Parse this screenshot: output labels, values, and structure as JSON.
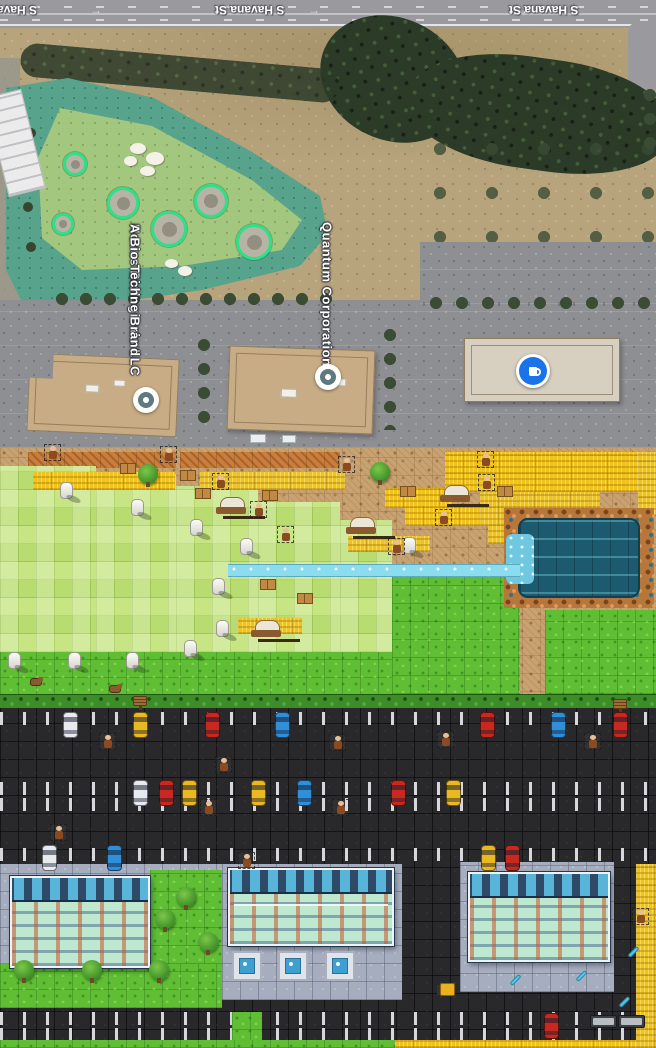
{
  "meta": {
    "title": "Aerial satellite map above pixel-art game recreation of the same area",
    "canvas": {
      "width": 656,
      "height": 1048
    }
  },
  "satellite": {
    "street": {
      "label_full_1": "S Havana St",
      "label_full_2": "S Havana St",
      "label_partial": "S Havana St",
      "direction_arrow": "→"
    },
    "pois": [
      {
        "id": "novus",
        "label_line_1": "Novus Biologicals LLC",
        "label_line_2": "A Bio-Techne Brand",
        "marker": "dot",
        "x": 146,
        "y": 400
      },
      {
        "id": "quantum",
        "label_line_1": "Quantum Corporation",
        "marker": "dot",
        "x": 328,
        "y": 377
      },
      {
        "id": "cafe",
        "marker": "cafe-blue-circle",
        "x": 533,
        "y": 371
      }
    ],
    "range_targets": [
      [
        78,
        167,
        12
      ],
      [
        66,
        227,
        11
      ],
      [
        126,
        206,
        16
      ],
      [
        172,
        232,
        18
      ],
      [
        214,
        204,
        17
      ],
      [
        257,
        245,
        18
      ]
    ],
    "colors": {
      "road": "#9a9a9e",
      "dirt": "#b7a47c",
      "range_outer": "#57a38c",
      "range_inner": "#a3c77e",
      "target_ring": "#2fe08a",
      "trees": "#2c3a28",
      "parking": "#8d8f93",
      "roof_tan": "#c8ac85",
      "roof_light": "#d7cfc0",
      "marker_blue": "#1a73e8"
    }
  },
  "game": {
    "colors": {
      "dirt": "#c9a271",
      "tilled": "#c97f3b",
      "wheat": "#eec31d",
      "grass_light": "#b9dc70",
      "grass_mid": "#5fbe33",
      "hedge": "#3c8d28",
      "water_dark": "#1c5a70",
      "water_light": "#8adcee",
      "rock": "#b5773c",
      "road": "#29292c",
      "sidewalk": "#a6adbf",
      "building_roof": "#2e4a66",
      "building_floor": "#bfe8d0",
      "car": {
        "white": "#e9eaf0",
        "yellow": "#eab821",
        "red": "#c8281e",
        "blue": "#2f8fd8"
      }
    },
    "interactable_types": [
      "npc",
      "wagon",
      "forklift"
    ],
    "terrain": [
      [
        "dirt",
        [
          0,
          448,
          656,
          262
        ]
      ],
      [
        "tilled",
        [
          28,
          452,
          148,
          16
        ]
      ],
      [
        "tilled",
        [
          180,
          452,
          160,
          16
        ]
      ],
      [
        "field",
        [
          0,
          466,
          96,
          186
        ]
      ],
      [
        "field",
        [
          96,
          474,
          80,
          178
        ]
      ],
      [
        "field",
        [
          176,
          486,
          82,
          166
        ]
      ],
      [
        "field",
        [
          258,
          502,
          82,
          150
        ]
      ],
      [
        "field",
        [
          340,
          520,
          52,
          132
        ]
      ],
      [
        "wheat",
        [
          33,
          472,
          142,
          18
        ]
      ],
      [
        "wheat",
        [
          200,
          472,
          145,
          18
        ]
      ],
      [
        "wheat",
        [
          385,
          488,
          67,
          20
        ]
      ],
      [
        "wheat",
        [
          405,
          506,
          115,
          20
        ]
      ],
      [
        "wheat",
        [
          488,
          524,
          92,
          20
        ]
      ],
      [
        "wheat",
        [
          445,
          452,
          211,
          40
        ]
      ],
      [
        "wheat",
        [
          480,
          492,
          120,
          34
        ]
      ],
      [
        "wheat",
        [
          638,
          452,
          18,
          64
        ]
      ],
      [
        "wheat",
        [
          348,
          536,
          82,
          16
        ]
      ],
      [
        "wheat",
        [
          238,
          618,
          64,
          16
        ]
      ],
      [
        "wheat",
        [
          545,
          690,
          111,
          14
        ]
      ],
      [
        "mid",
        [
          0,
          652,
          392,
          44
        ]
      ],
      [
        "mid",
        [
          392,
          576,
          128,
          118
        ]
      ],
      [
        "mid",
        [
          545,
          610,
          111,
          84
        ]
      ],
      [
        "rocks",
        [
          504,
          508,
          150,
          100
        ]
      ],
      [
        "water",
        [
          518,
          518,
          122,
          80
        ]
      ],
      [
        "rapids",
        [
          506,
          534,
          28,
          50
        ]
      ],
      [
        "stream",
        [
          228,
          564,
          292,
          13
        ]
      ],
      [
        "hedge",
        [
          0,
          694,
          656,
          14
        ]
      ],
      [
        "road",
        [
          0,
          708,
          656,
          340
        ]
      ],
      [
        "ticks",
        [
          0,
          712,
          656,
          13
        ]
      ],
      [
        "ticks",
        [
          0,
          782,
          656,
          13
        ]
      ],
      [
        "ticks",
        [
          0,
          798,
          656,
          13
        ]
      ],
      [
        "ticks",
        [
          0,
          848,
          656,
          13
        ]
      ],
      [
        "ticks",
        [
          0,
          1012,
          656,
          13
        ]
      ],
      [
        "ticks",
        [
          0,
          1028,
          656,
          13
        ]
      ],
      [
        "walk",
        [
          0,
          864,
          222,
          100
        ]
      ],
      [
        "walk",
        [
          222,
          864,
          180,
          136
        ]
      ],
      [
        "walk",
        [
          460,
          862,
          154,
          130
        ]
      ],
      [
        "mid",
        [
          150,
          870,
          72,
          94
        ]
      ],
      [
        "mid",
        [
          0,
          964,
          222,
          44
        ]
      ],
      [
        "mid",
        [
          232,
          1012,
          30,
          36
        ]
      ],
      [
        "mid",
        [
          0,
          1040,
          395,
          8
        ]
      ],
      [
        "wheat",
        [
          395,
          1040,
          261,
          8
        ]
      ],
      [
        "wheat",
        [
          636,
          864,
          20,
          184
        ]
      ]
    ],
    "sprites": {
      "silo": [
        [
          60,
          482
        ],
        [
          131,
          499
        ],
        [
          190,
          519
        ],
        [
          240,
          538
        ],
        [
          212,
          578
        ],
        [
          8,
          652
        ],
        [
          68,
          652
        ],
        [
          126,
          652
        ],
        [
          184,
          640
        ],
        [
          403,
          537
        ],
        [
          216,
          620
        ]
      ],
      "wagon": [
        [
          216,
          497
        ],
        [
          440,
          485
        ],
        [
          346,
          517
        ],
        [
          251,
          620
        ]
      ],
      "npc": [
        [
          44,
          444
        ],
        [
          160,
          446
        ],
        [
          212,
          473
        ],
        [
          250,
          501
        ],
        [
          277,
          526
        ],
        [
          338,
          456
        ],
        [
          477,
          451
        ],
        [
          478,
          474
        ],
        [
          435,
          509
        ],
        [
          388,
          538
        ],
        [
          99,
          733
        ],
        [
          329,
          734
        ],
        [
          215,
          756
        ],
        [
          200,
          799
        ],
        [
          332,
          799
        ],
        [
          50,
          824
        ],
        [
          238,
          852
        ],
        [
          437,
          731
        ],
        [
          584,
          733
        ],
        [
          632,
          908
        ]
      ],
      "hay": [
        [
          120,
          463
        ],
        [
          180,
          470
        ],
        [
          195,
          488
        ],
        [
          262,
          490
        ],
        [
          400,
          486
        ],
        [
          497,
          486
        ],
        [
          260,
          579
        ],
        [
          297,
          593
        ]
      ],
      "tree_dirt": [
        [
          138,
          464
        ],
        [
          370,
          462
        ]
      ],
      "tree": [
        [
          14,
          960
        ],
        [
          82,
          960
        ],
        [
          149,
          960
        ],
        [
          155,
          909
        ],
        [
          176,
          887
        ],
        [
          198,
          932
        ]
      ],
      "sign": [
        [
          133,
          696
        ],
        [
          613,
          699
        ]
      ],
      "dog": [
        [
          30,
          678
        ],
        [
          109,
          685
        ]
      ],
      "blue_tool": [
        [
          509,
          978
        ],
        [
          575,
          974
        ],
        [
          627,
          950
        ],
        [
          618,
          1000
        ]
      ],
      "forklift": [
        [
          440,
          983
        ]
      ],
      "fountain": [
        [
          232,
          951
        ],
        [
          278,
          951
        ],
        [
          325,
          951
        ]
      ]
    },
    "vehicles": {
      "rows": [
        {
          "y": 712,
          "cars": [
            [
              "white",
              63
            ],
            [
              "yellow",
              133
            ],
            [
              "red",
              205
            ],
            [
              "blue",
              275
            ],
            [
              "red",
              480
            ],
            [
              "blue",
              551
            ],
            [
              "red",
              613
            ]
          ]
        },
        {
          "y": 780,
          "cars": [
            [
              "white",
              133
            ],
            [
              "red",
              159
            ],
            [
              "yellow",
              182
            ],
            [
              "yellow",
              251
            ],
            [
              "blue",
              297
            ],
            [
              "red",
              391
            ],
            [
              "yellow",
              446
            ]
          ]
        },
        {
          "y": 845,
          "cars": [
            [
              "white",
              42
            ],
            [
              "blue",
              107
            ],
            [
              "yellow",
              481
            ],
            [
              "red",
              505
            ]
          ]
        },
        {
          "y": 1013,
          "cars": [
            [
              "red",
              544
            ]
          ]
        }
      ],
      "trucks": [
        [
          590,
          1015
        ],
        [
          618,
          1015
        ]
      ]
    }
  }
}
